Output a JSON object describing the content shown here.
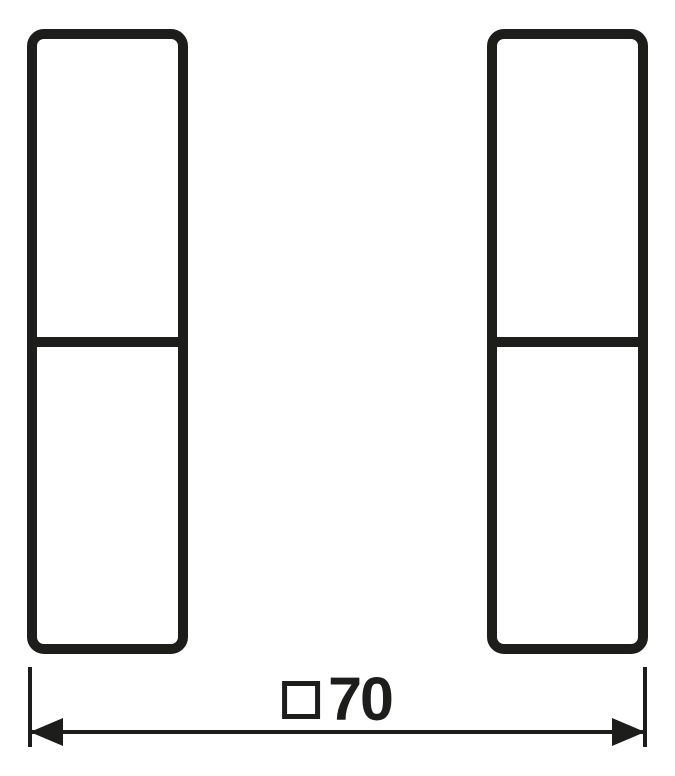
{
  "drawing": {
    "type": "technical-dimension-drawing",
    "background_color": "#ffffff",
    "line_color": "#1d1d1b",
    "rockers": [
      {
        "id": "left-rocker",
        "segments": 2
      },
      {
        "id": "right-rocker",
        "segments": 2
      }
    ],
    "dimension": {
      "symbol": "□",
      "value": "70",
      "label": "□70"
    }
  }
}
